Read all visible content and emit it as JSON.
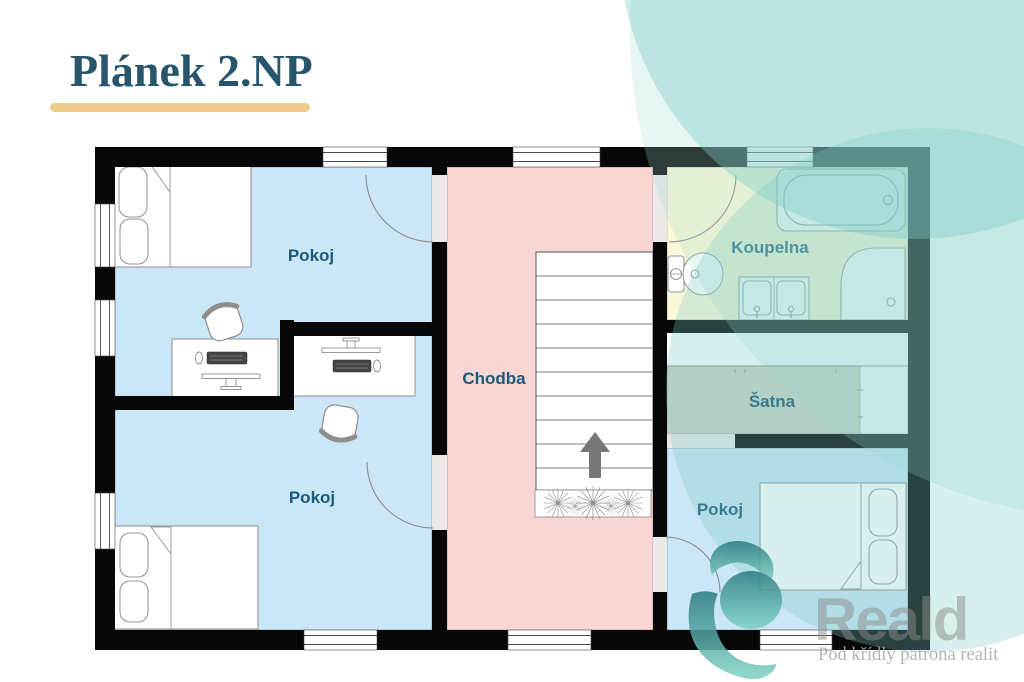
{
  "title": "Plánek 2.NP",
  "rooms": {
    "pokoj_top_left": "Pokoj",
    "pokoj_bottom_left": "Pokoj",
    "pokoj_bottom_right": "Pokoj",
    "chodba": "Chodba",
    "koupelna": "Koupelna",
    "satna": "Šatna"
  },
  "watermark": {
    "brand": "Reald",
    "tagline": "Pod křídly patrona realit"
  },
  "colors": {
    "room_blue": "#cae6f7",
    "hall_pink": "#f9d5d4",
    "bath_yellow": "#fbf8d9",
    "wardrobe_gray": "#cdd3c7",
    "accent_gold": "#efcb8d",
    "title_color": "#27566c",
    "label_color": "#1a5a7a",
    "decor_teal": "#7ccac5",
    "wall_black": "#070707"
  }
}
